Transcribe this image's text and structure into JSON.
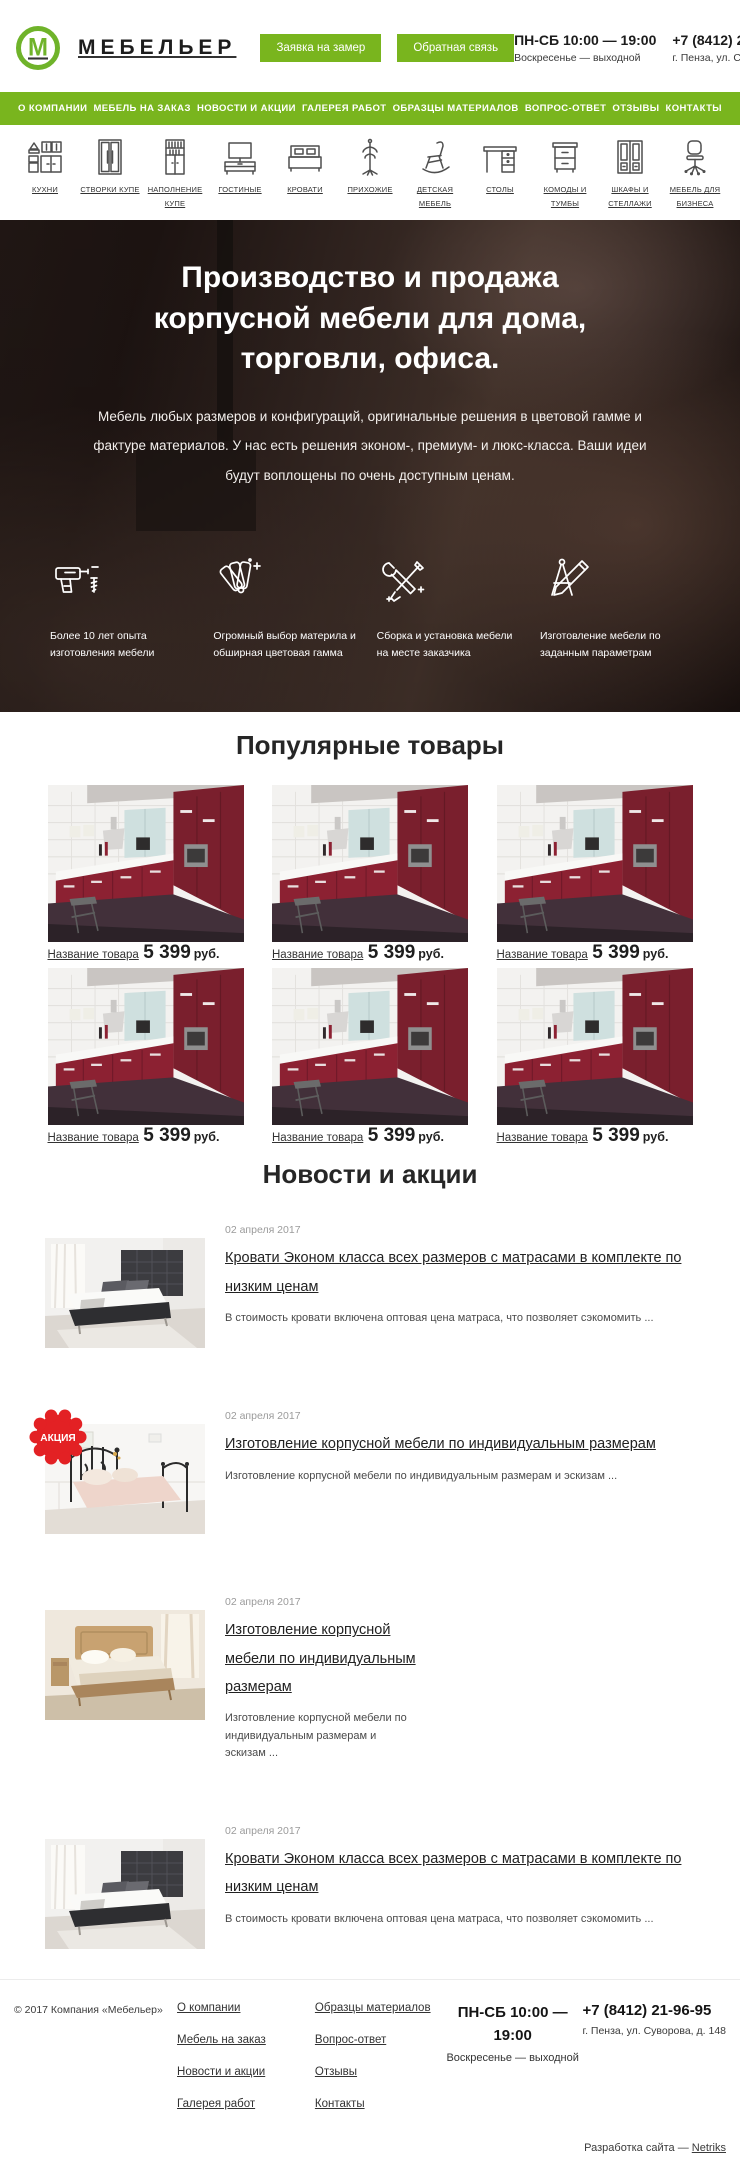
{
  "colors": {
    "brand_green": "#79b51e",
    "badge_red": "#e32124"
  },
  "header": {
    "logo_letter": "М",
    "brand": "МЕБЕЛЬЕР",
    "buttons": [
      {
        "label": "Заявка на замер"
      },
      {
        "label": "Обратная связь"
      }
    ],
    "hours_line1": "ПН-СБ 10:00 — 19:00",
    "hours_line2": "Воскресенье — выходной",
    "phone": "+7 (8412) 21-96-95",
    "address": "г. Пенза, ул. Суворова, д. 148"
  },
  "nav": {
    "items": [
      "О КОМПАНИИ",
      "МЕБЕЛЬ НА ЗАКАЗ",
      "НОВОСТИ И АКЦИИ",
      "ГАЛЕРЕЯ РАБОТ",
      "ОБРАЗЦЫ МАТЕРИАЛОВ",
      "ВОПРОС-ОТВЕТ",
      "ОТЗЫВЫ",
      "КОНТАКТЫ"
    ]
  },
  "categories": {
    "items": [
      {
        "label": "КУХНИ"
      },
      {
        "label": "СТВОРКИ КУПЕ"
      },
      {
        "label": "НАПОЛНЕНИЕ КУПЕ"
      },
      {
        "label": "ГОСТИНЫЕ"
      },
      {
        "label": "КРОВАТИ"
      },
      {
        "label": "ПРИХОЖИЕ"
      },
      {
        "label": "ДЕТСКАЯ МЕБЕЛЬ"
      },
      {
        "label": "СТОЛЫ"
      },
      {
        "label": "КОМОДЫ И ТУМБЫ"
      },
      {
        "label": "ШКАФЫ И СТЕЛЛАЖИ"
      },
      {
        "label": "МЕБЕЛЬ ДЛЯ БИЗНЕСА"
      }
    ]
  },
  "hero": {
    "title_lines": [
      "Производство и продажа",
      "корпусной мебели для дома,",
      "торговли, офиса."
    ],
    "subtitle": "Мебель любых размеров и конфигураций, оригинальные решения в цветовой гамме и фактуре материалов. У нас есть решения эконом-, премиум- и люкс-класса. Ваши идеи будут воплощены по очень доступным ценам.",
    "features": [
      {
        "icon": "drill-icon",
        "label": "Более 10 лет опыта изготовления мебели"
      },
      {
        "icon": "color-palette-icon",
        "label": "Огромный выбор материла и обширная цветовая гамма"
      },
      {
        "icon": "tools-icon",
        "label": "Сборка и установка мебели на месте заказчика"
      },
      {
        "icon": "drafting-tools-icon",
        "label": "Изготовление мебели по заданным параметрам"
      }
    ]
  },
  "products": {
    "title": "Популярные товары",
    "items": [
      {
        "name": "Название товара",
        "price": "5 399",
        "currency": "руб."
      },
      {
        "name": "Название товара",
        "price": "5 399",
        "currency": "руб."
      },
      {
        "name": "Название товара",
        "price": "5 399",
        "currency": "руб."
      },
      {
        "name": "Название товара",
        "price": "5 399",
        "currency": "руб."
      },
      {
        "name": "Название товара",
        "price": "5 399",
        "currency": "руб."
      },
      {
        "name": "Название товара",
        "price": "5 399",
        "currency": "руб."
      }
    ]
  },
  "news": {
    "title": "Новости и акции",
    "items": [
      {
        "date": "02 апреля 2017",
        "title": "Кровати Эконом класса всех размеров с матрасами в комплекте по низким ценам",
        "excerpt": "В стоимость кровати включена оптовая цена матраса, что позволяет сэкомомить ...",
        "badge": ""
      },
      {
        "date": "02 апреля 2017",
        "title": "Изготовление корпусной мебели по индивидуальным размерам",
        "excerpt": "Изготовление корпусной мебели по индивидуальным размерам и эскизам ...",
        "badge": "АКЦИЯ"
      },
      {
        "date": "02 апреля 2017",
        "title": "Изготовление корпусной мебели по индивидуальным размерам",
        "excerpt": "Изготовление корпусной мебели по индивидуальным размерам и эскизам ...",
        "badge": ""
      },
      {
        "date": "02 апреля 2017",
        "title": "Кровати Эконом класса всех размеров с матрасами в комплекте по низким ценам",
        "excerpt": "В стоимость кровати включена оптовая цена матраса, что позволяет сэкомомить ...",
        "badge": ""
      }
    ]
  },
  "footer": {
    "copyright": "© 2017 Компания «Мебельер»",
    "links_col1": [
      "О компании",
      "Мебель на заказ",
      "Новости и акции",
      "Галерея работ"
    ],
    "links_col2": [
      "Образцы материалов",
      "Вопрос-ответ",
      "Отзывы",
      "Контакты"
    ],
    "hours_line1": "ПН-СБ 10:00 — 19:00",
    "hours_line2": "Воскресенье — выходной",
    "phone": "+7 (8412) 21-96-95",
    "address": "г. Пенза, ул. Суворова, д. 148",
    "credit_prefix": "Разработка сайта — ",
    "credit_link": "Netriks"
  }
}
